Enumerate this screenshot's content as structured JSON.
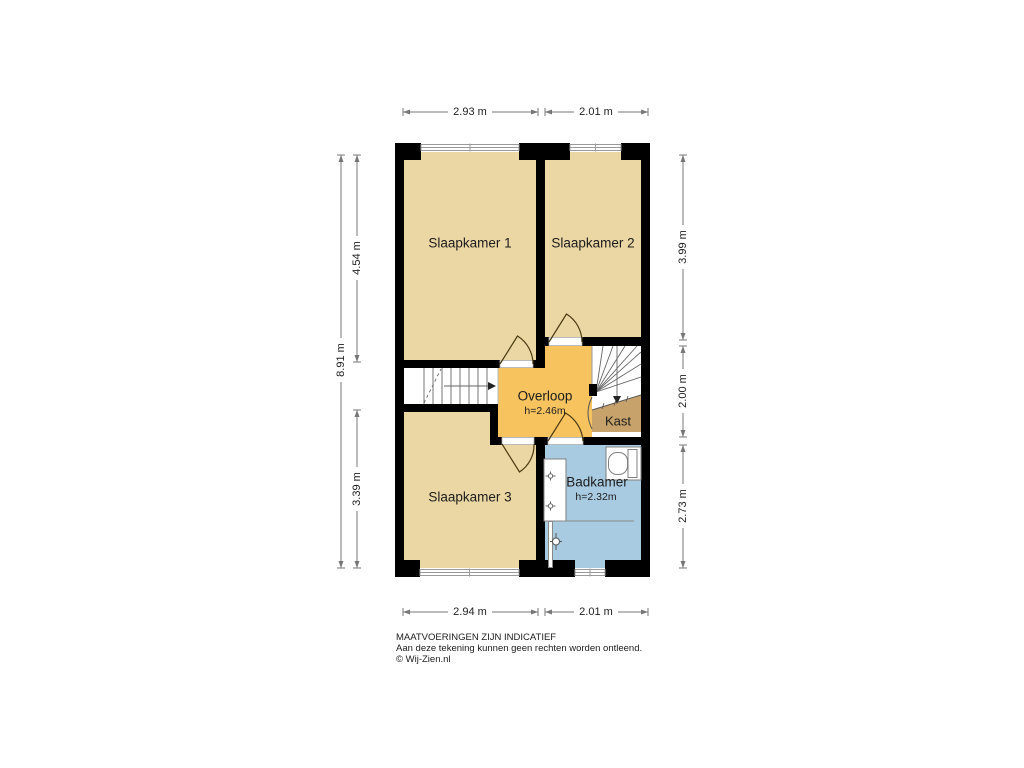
{
  "rooms": {
    "slaapkamer1": {
      "label": "Slaapkamer 1"
    },
    "slaapkamer2": {
      "label": "Slaapkamer 2"
    },
    "slaapkamer3": {
      "label": "Slaapkamer 3"
    },
    "overloop": {
      "label": "Overloop",
      "height": "h=2.46m"
    },
    "kast": {
      "label": "Kast"
    },
    "badkamer": {
      "label": "Badkamer",
      "height": "h=2.32m"
    }
  },
  "dimensions": {
    "top": {
      "left": "2.93 m",
      "right": "2.01 m"
    },
    "bottom": {
      "left": "2.94 m",
      "right": "2.01 m"
    },
    "left": {
      "outer": "8.91 m",
      "top": "4.54 m",
      "bottom": "3.39 m"
    },
    "right": {
      "top": "3.99 m",
      "middle": "2.00 m",
      "bottom": "2.73 m"
    }
  },
  "footer": {
    "line1": "MAATVOERINGEN ZIJN INDICATIEF",
    "line2": "Aan deze tekening kunnen geen rechten worden ontleend.",
    "line3": "© Wij-Zien.nl"
  },
  "colors": {
    "room": "#EBD7A4",
    "landing": "#F6C35F",
    "bathroom": "#A9CBE1",
    "closet": "#C8A26B",
    "wall": "#000000"
  }
}
